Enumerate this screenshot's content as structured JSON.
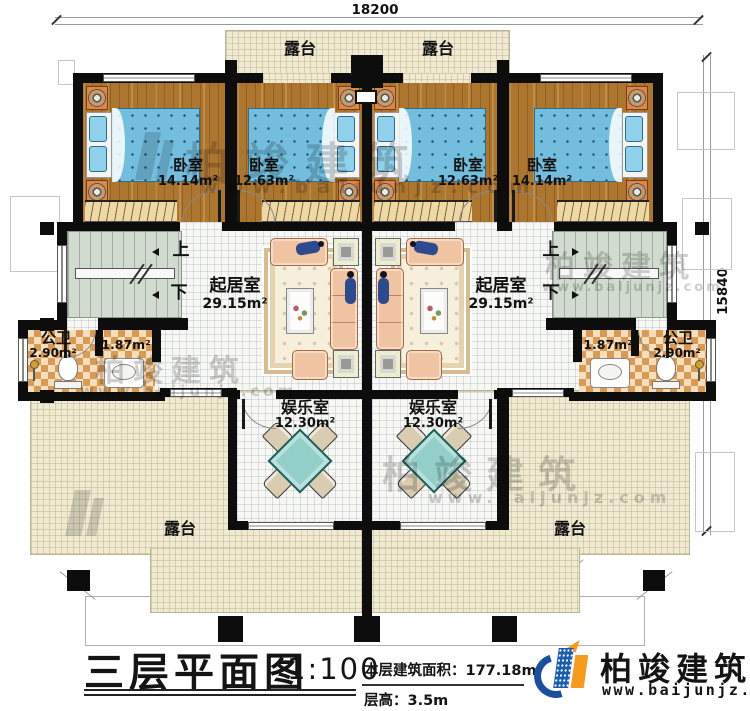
{
  "plan": {
    "dimension_top": "18200",
    "dimension_right": "15840"
  },
  "rooms": {
    "terrace_top_left": {
      "name": "露台"
    },
    "terrace_top_right": {
      "name": "露台"
    },
    "bedroom_1": {
      "name": "卧室",
      "area": "14.14m²"
    },
    "bedroom_2": {
      "name": "卧室",
      "area": "12.63m²"
    },
    "bedroom_3": {
      "name": "卧室",
      "area": "12.63m²"
    },
    "bedroom_4": {
      "name": "卧室",
      "area": "14.14m²"
    },
    "living_left": {
      "name": "起居室",
      "area": "29.15m²"
    },
    "living_right": {
      "name": "起居室",
      "area": "29.15m²"
    },
    "bath_left": {
      "name": "公卫",
      "area": "2.90m²",
      "sub_area": "1.87m²"
    },
    "bath_right": {
      "name": "公卫",
      "area": "2.90m²",
      "sub_area": "1.87m²"
    },
    "entertainment_left": {
      "name": "娱乐室",
      "area": "12.30m²"
    },
    "entertainment_right": {
      "name": "娱乐室",
      "area": "12.30m²"
    },
    "terrace_bottom_left": {
      "name": "露台"
    },
    "terrace_bottom_right": {
      "name": "露台"
    }
  },
  "stairs": {
    "up_label": "上",
    "down_label": "下"
  },
  "title_block": {
    "title": "三层平面图",
    "scale": "1:100",
    "floor_area": "本层建筑面积：177.18m²",
    "floor_height": "层高：3.5m"
  },
  "logo": {
    "name": "柏竣建筑",
    "website": "www.baijunjz.com"
  },
  "watermark": {
    "brand": "柏竣建筑",
    "website": "www.baijunjz.com"
  },
  "colors": {
    "wall": "#0d0d0d",
    "wood_floor": "#ac762e",
    "terrace": "#f0ead3",
    "bed": "#74bedd",
    "logo_blue": "#1a5cae",
    "logo_orange": "#f59b1e"
  }
}
